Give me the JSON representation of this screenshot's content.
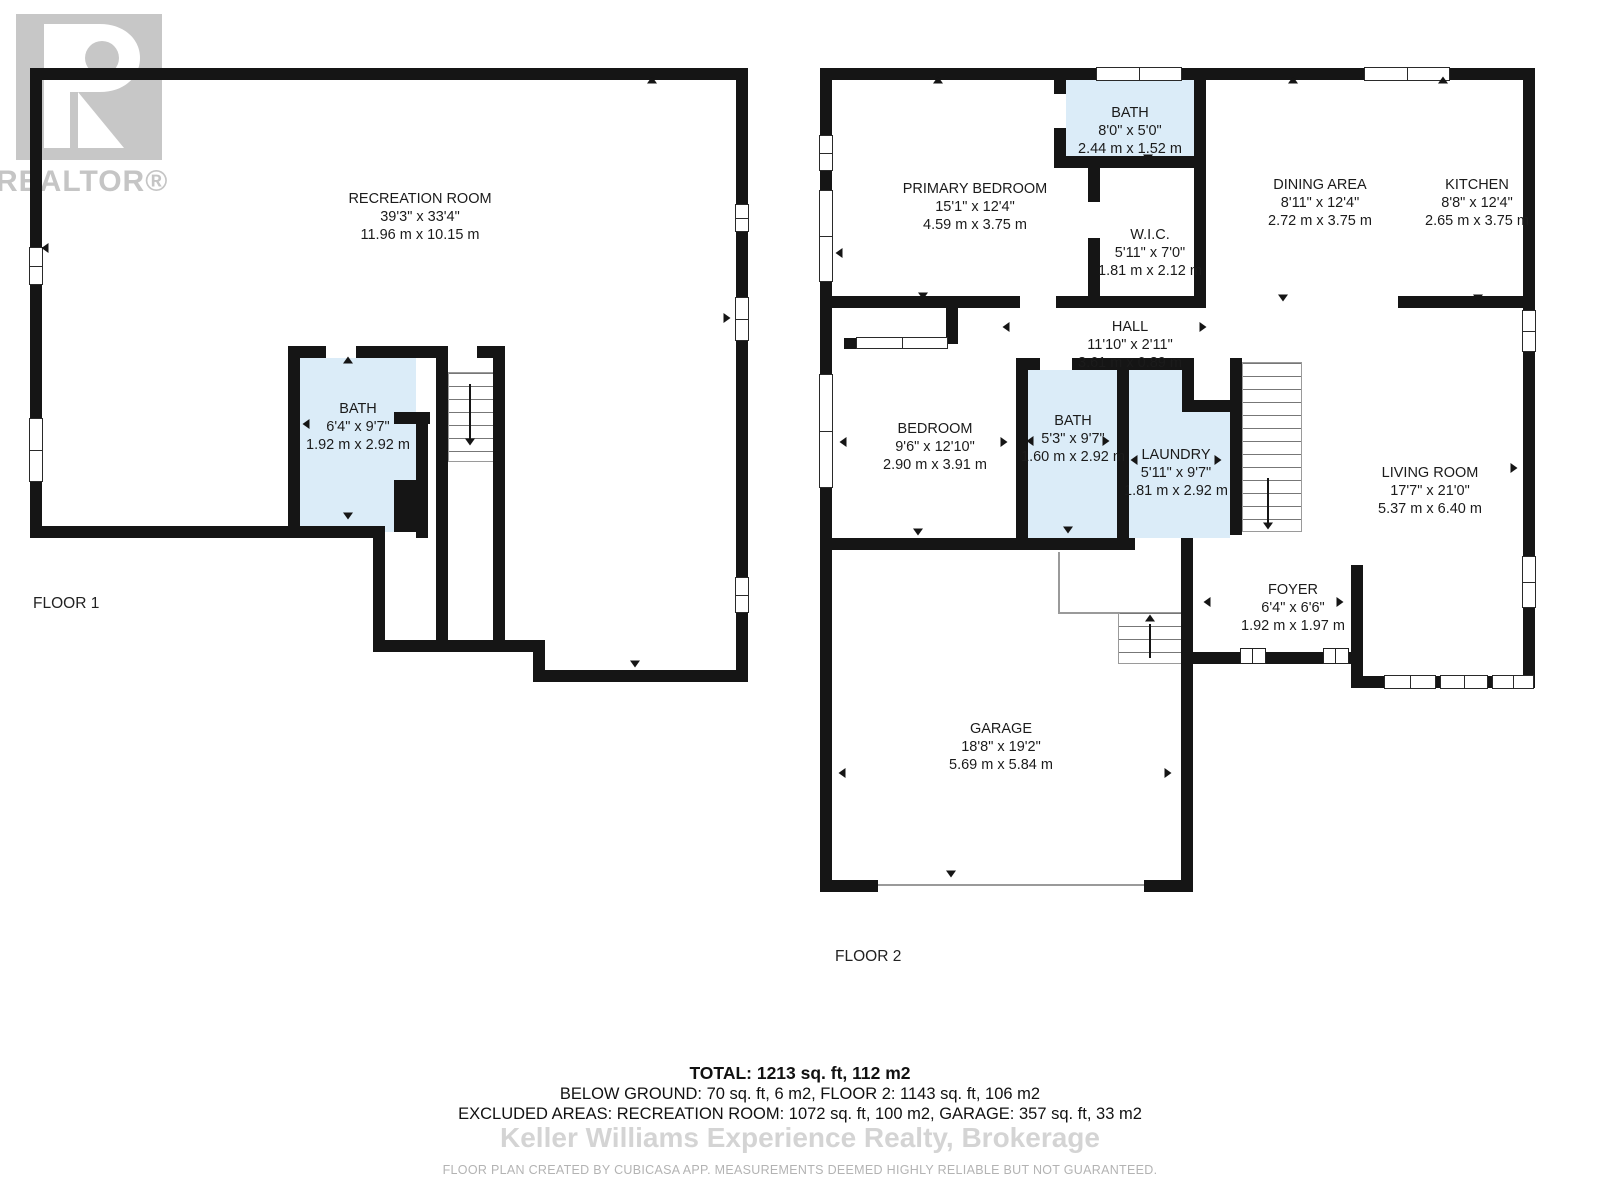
{
  "branding": {
    "logo_text": "REALTOR®",
    "watermark": "Keller Williams Experience Realty, Brokerage",
    "disclaimer": "FLOOR PLAN CREATED BY CUBICASA APP. MEASUREMENTS DEEMED HIGHLY RELIABLE BUT NOT GUARANTEED."
  },
  "summary": {
    "total": "TOTAL: 1213 sq. ft, 112 m2",
    "below_ground": "BELOW GROUND: 70 sq. ft, 6 m2, FLOOR 2: 1143 sq. ft, 106 m2",
    "excluded": "EXCLUDED AREAS: RECREATION ROOM: 1072 sq. ft, 100 m2, GARAGE: 357 sq. ft, 33 m2"
  },
  "floors": [
    {
      "label": "FLOOR 1",
      "rooms": [
        {
          "name": "RECREATION ROOM",
          "imperial": "39'3\" x 33'4\"",
          "metric": "11.96 m x 10.15 m"
        },
        {
          "name": "BATH",
          "imperial": "6'4\" x 9'7\"",
          "metric": "1.92 m x 2.92 m"
        }
      ]
    },
    {
      "label": "FLOOR 2",
      "rooms": [
        {
          "name": "PRIMARY BEDROOM",
          "imperial": "15'1\" x 12'4\"",
          "metric": "4.59 m x 3.75 m"
        },
        {
          "name": "BATH",
          "imperial": "8'0\" x 5'0\"",
          "metric": "2.44 m x 1.52 m"
        },
        {
          "name": "W.I.C.",
          "imperial": "5'11\" x 7'0\"",
          "metric": "1.81 m x 2.12 m"
        },
        {
          "name": "DINING AREA",
          "imperial": "8'11\" x 12'4\"",
          "metric": "2.72 m x 3.75 m"
        },
        {
          "name": "KITCHEN",
          "imperial": "8'8\" x 12'4\"",
          "metric": "2.65 m x 3.75 m"
        },
        {
          "name": "HALL",
          "imperial": "11'10\" x 2'11\"",
          "metric": "3.61 m x 0.89 m"
        },
        {
          "name": "BEDROOM",
          "imperial": "9'6\" x 12'10\"",
          "metric": "2.90 m x 3.91 m"
        },
        {
          "name": "BATH",
          "imperial": "5'3\" x 9'7\"",
          "metric": "1.60 m x 2.92 m"
        },
        {
          "name": "LAUNDRY",
          "imperial": "5'11\" x 9'7\"",
          "metric": "1.81 m x 2.92 m"
        },
        {
          "name": "LIVING ROOM",
          "imperial": "17'7\" x 21'0\"",
          "metric": "5.37 m x 6.40 m"
        },
        {
          "name": "FOYER",
          "imperial": "6'4\" x 6'6\"",
          "metric": "1.92 m x 1.97 m"
        },
        {
          "name": "GARAGE",
          "imperial": "18'8\" x 19'2\"",
          "metric": "5.69 m x 5.84 m"
        }
      ]
    }
  ],
  "colors": {
    "wall": "#151515",
    "wet_room_fill": "#dbecf8",
    "logo_gray": "#c7c7c7"
  }
}
